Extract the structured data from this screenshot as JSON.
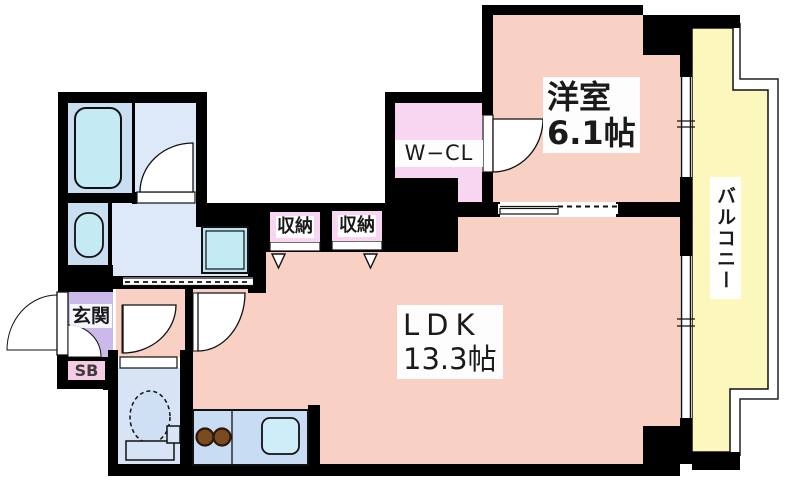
{
  "floorplan": {
    "western_room": {
      "name": "洋室",
      "size": "6.1帖"
    },
    "ldk": {
      "name": "LDK",
      "size": "13.3帖"
    },
    "walk_in_closet": {
      "label": "W−CL"
    },
    "storage_left": {
      "label": "収納"
    },
    "storage_right": {
      "label": "収納"
    },
    "entrance": {
      "label": "玄関"
    },
    "shoe_box": {
      "label": "SB"
    },
    "balcony": {
      "label": "バルコニー"
    },
    "colors": {
      "wall": "#000000",
      "room_pink": "#f8d0c4",
      "closet_pink": "#f8d6f2",
      "shoe_box_pink": "#f6cbe5",
      "entrance_purple": "#cbb9e9",
      "balcony_yellow": "#fbf7bd",
      "bath_blue": "#cadef2",
      "washroom_blue": "#dde9f8",
      "toilet_blue": "#d6e4f6",
      "kitchen_blue": "#c8dcf4",
      "fixture_cyan": "#c4eaf4",
      "burner_brown": "#7b4b20"
    }
  }
}
